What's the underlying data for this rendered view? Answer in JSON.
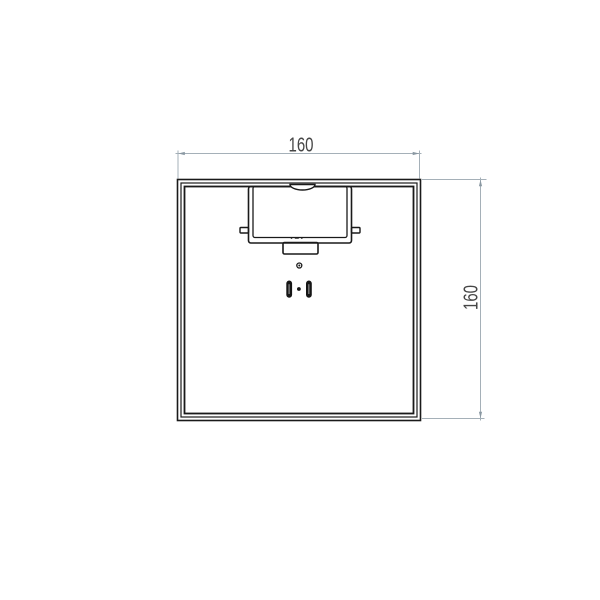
{
  "drawing": {
    "type": "technical-drawing",
    "view": "top-view-square-part",
    "labels": {
      "width_dim": "160",
      "height_dim": "160"
    },
    "colors": {
      "background": "#ffffff",
      "part_line": "#1a1a1a",
      "dimension_line": "#a5b0b8",
      "dimension_arrow": "#8a98a2",
      "dimension_text": "#464646",
      "slot_fill": "#161616"
    }
  }
}
